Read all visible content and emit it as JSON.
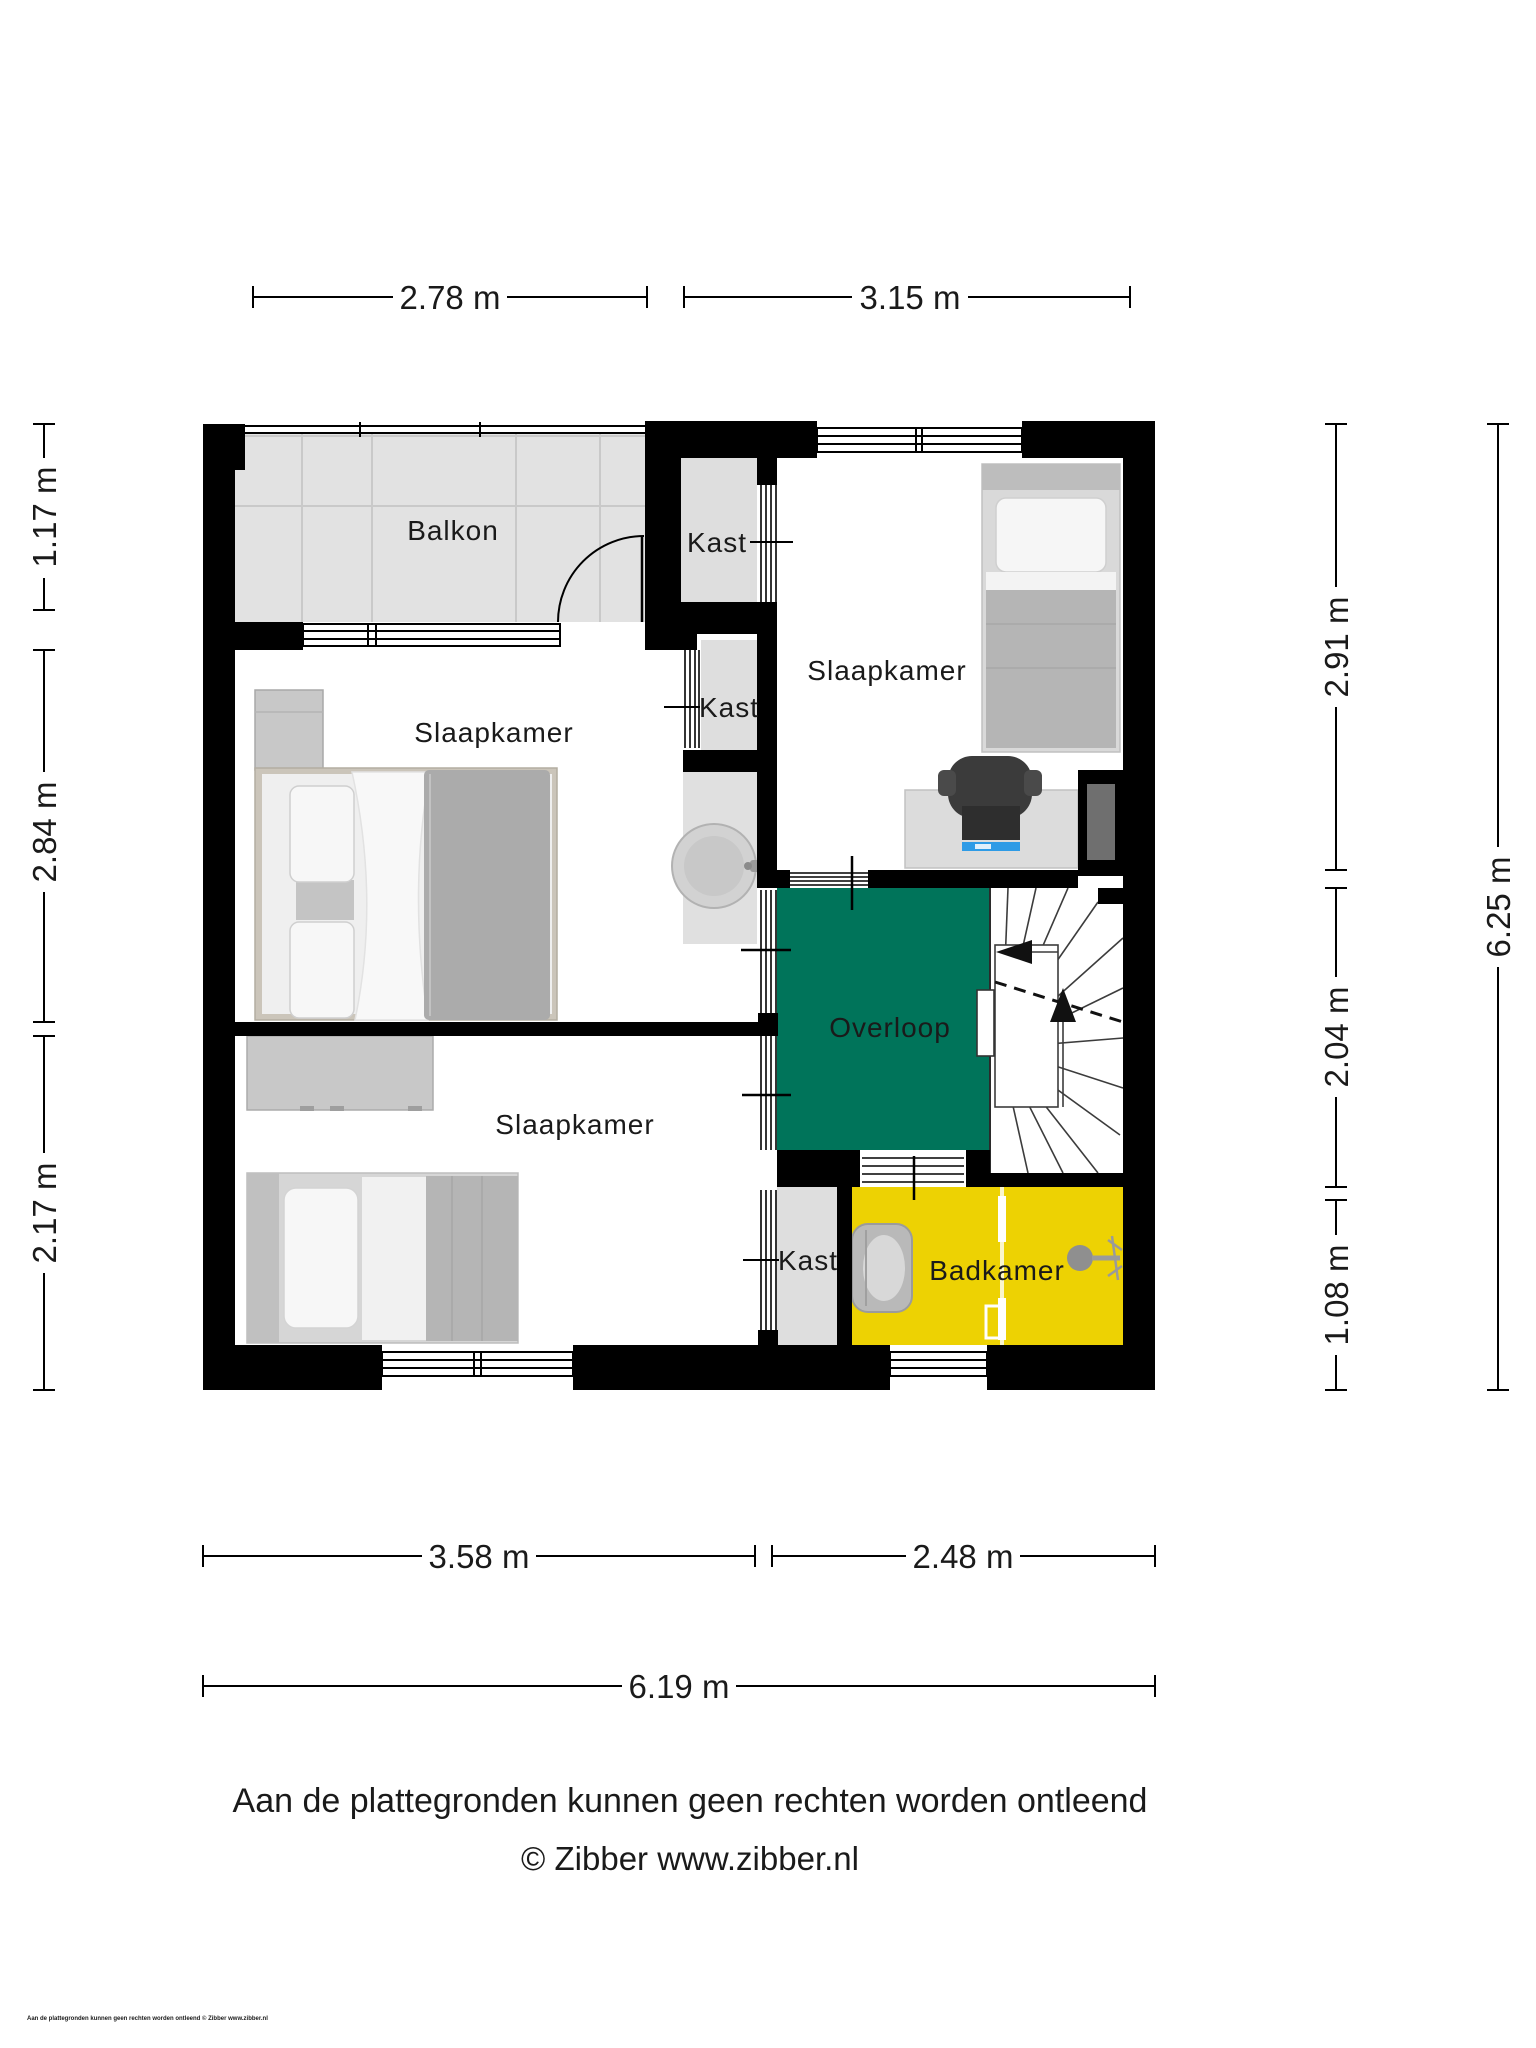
{
  "rooms": {
    "balkon": "Balkon",
    "kast_top": "Kast",
    "kast_middle": "Kast",
    "kast_bottom": "Kast",
    "slaapkamer_right": "Slaapkamer",
    "slaapkamer_left": "Slaapkamer",
    "slaapkamer_bottom": "Slaapkamer",
    "overloop": "Overloop",
    "badkamer": "Badkamer"
  },
  "dimensions": {
    "top_left": "2.78 m",
    "top_right": "3.15 m",
    "left_top": "1.17 m",
    "left_middle": "2.84 m",
    "left_bottom": "2.17 m",
    "right_top": "2.91 m",
    "right_middle": "2.04 m",
    "right_bottom": "1.08 m",
    "right_total": "6.25 m",
    "bottom_left": "3.58 m",
    "bottom_right": "2.48 m",
    "bottom_total": "6.19 m"
  },
  "footer": {
    "disclaimer": "Aan de plattegronden kunnen geen rechten worden ontleend",
    "copyright": "© Zibber www.zibber.nl",
    "fine_print": "Aan de plattegronden kunnen geen rechten worden ontleend © Zibber www.zibber.nl"
  },
  "colors": {
    "overloop_green": "#00745A",
    "badkamer_yellow": "#EDD203",
    "wall_black": "#000000",
    "floor_light": "#E2E2E2",
    "niche_gray": "#6F6F6F"
  }
}
